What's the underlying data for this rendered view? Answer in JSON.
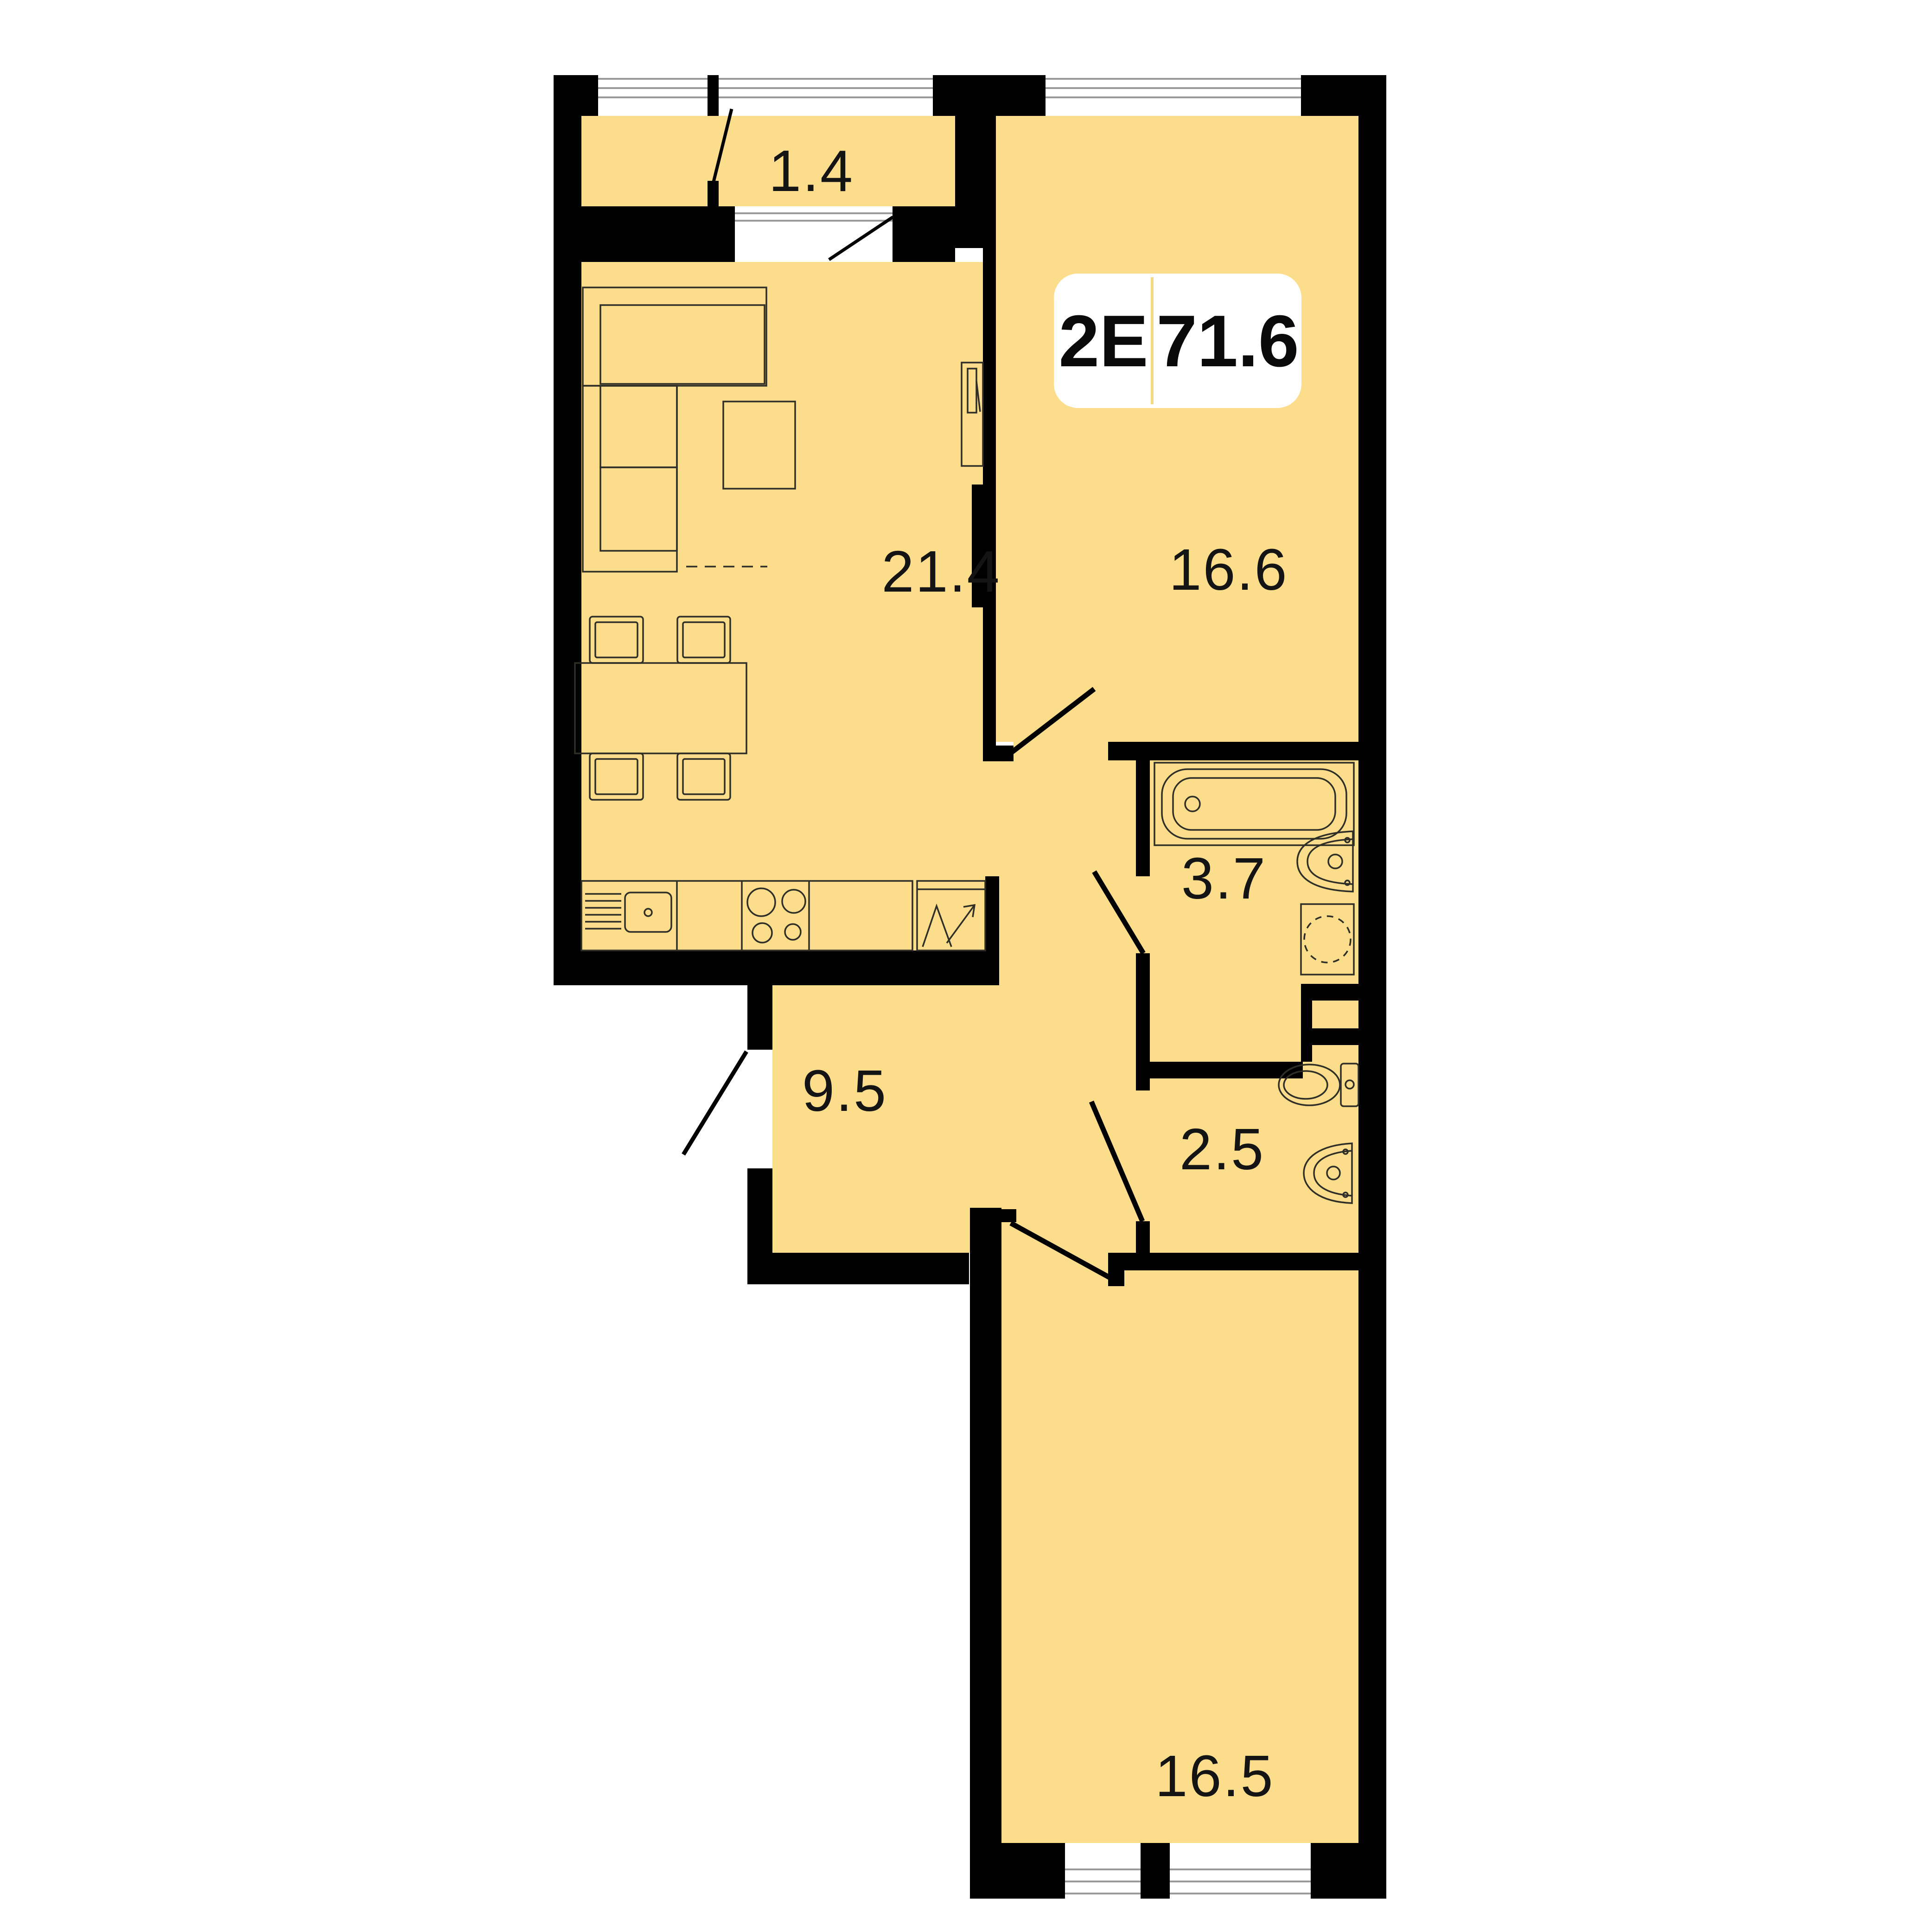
{
  "plan": {
    "badge": {
      "type_label": "2E",
      "area_label": "71.6"
    },
    "rooms": [
      {
        "id": "balcony",
        "area": "1.4"
      },
      {
        "id": "living-kitchen",
        "area": "21.4"
      },
      {
        "id": "bedroom",
        "area": "16.6"
      },
      {
        "id": "bathroom",
        "area": "3.7"
      },
      {
        "id": "hallway",
        "area": "9.5"
      },
      {
        "id": "wc",
        "area": "2.5"
      },
      {
        "id": "bedroom-2",
        "area": "16.5"
      }
    ],
    "colors": {
      "background": "#FFFFFF",
      "room_fill": "#FBDD8C",
      "wall": "#000000",
      "outline": "#2F2F28",
      "glazing": "#9A9A9A",
      "label": "#141414",
      "badge_bg": "#FFFFFF",
      "badge_divider": "#F6D97E",
      "badge_text": "#0A0A0A"
    }
  }
}
